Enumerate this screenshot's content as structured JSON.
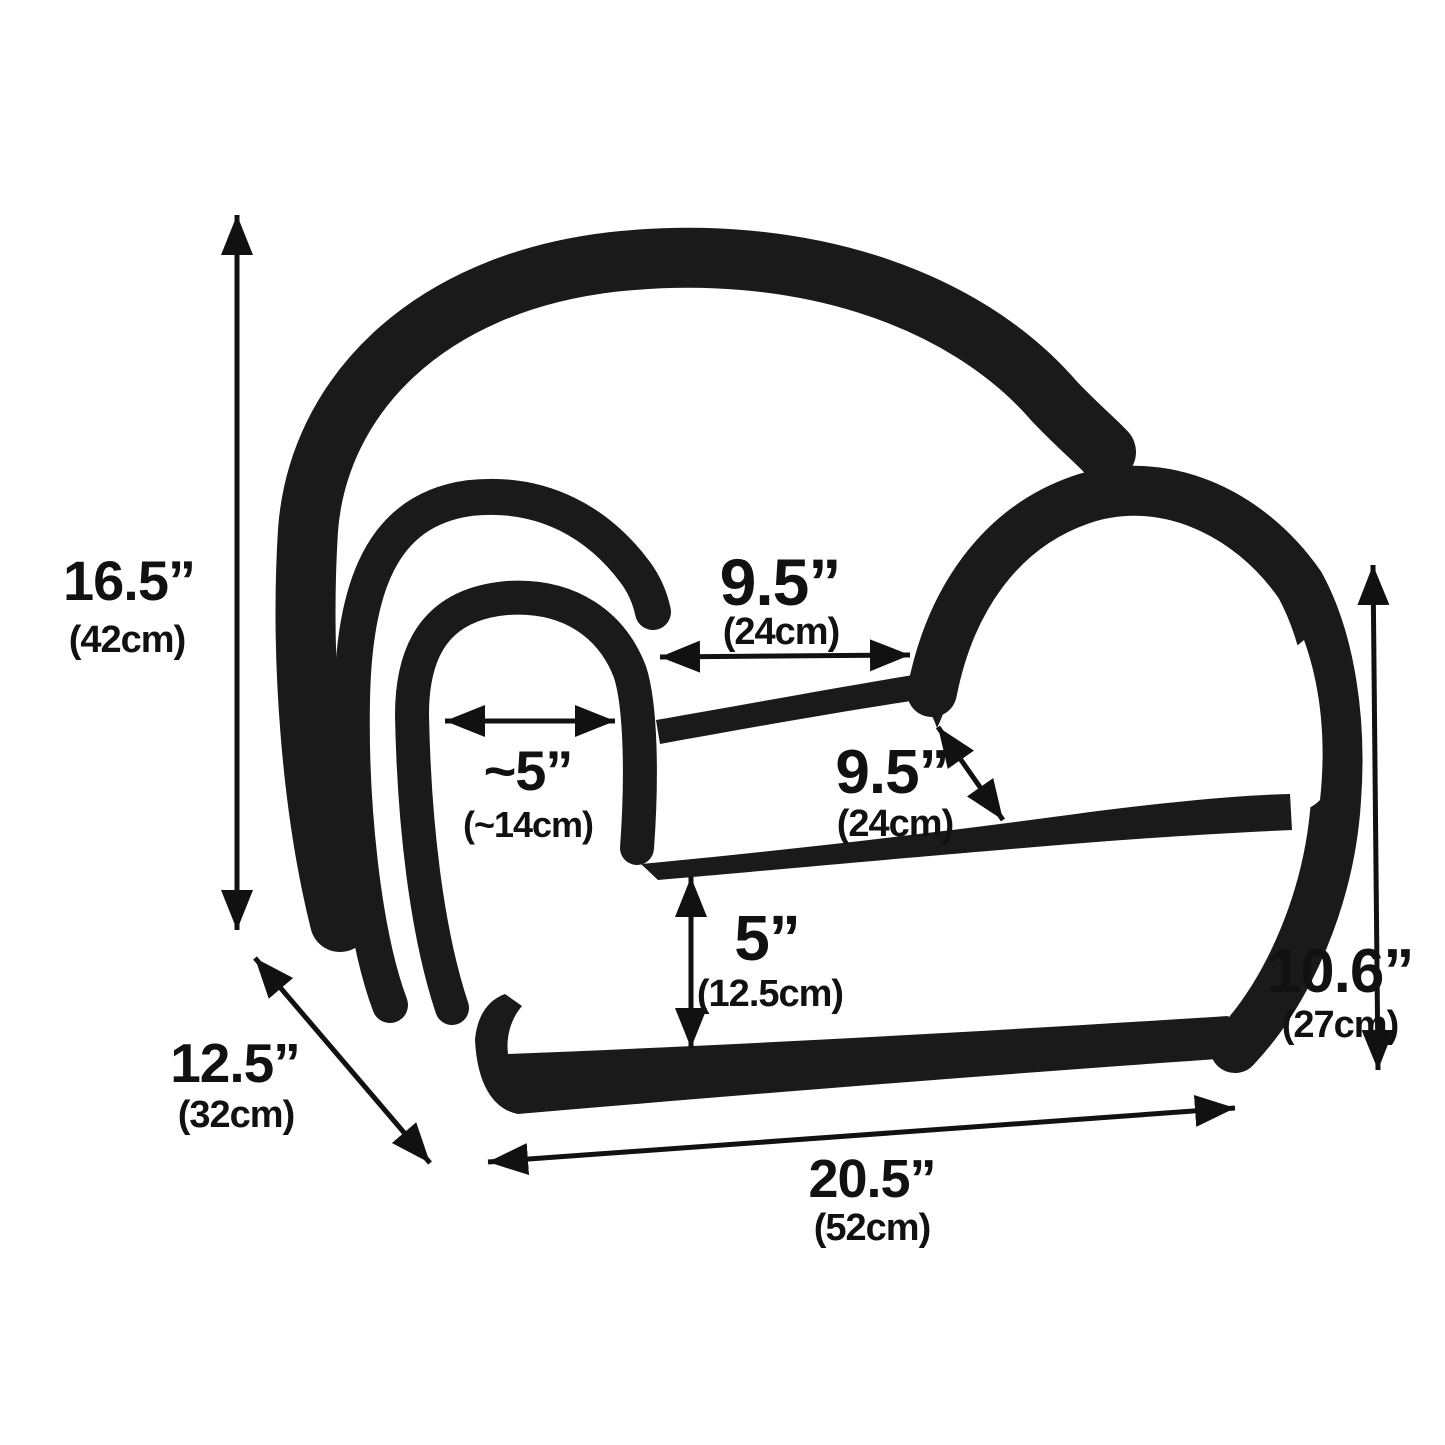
{
  "diagram": {
    "kind": "product-dimension-line-drawing",
    "subject": "kids foam armchair",
    "background_color": "#ffffff",
    "ink_color": "#1a1a1a",
    "dimensions": {
      "overall_height": {
        "inches": "16.5”",
        "metric": "(42cm)"
      },
      "depth": {
        "inches": "12.5”",
        "metric": "(32cm)"
      },
      "overall_width": {
        "inches": "20.5”",
        "metric": "(52cm)"
      },
      "back_height": {
        "inches": "10.6”",
        "metric": "(27cm)"
      },
      "seat_width": {
        "inches": "9.5”",
        "metric": "(24cm)"
      },
      "armrest_width": {
        "inches": "~5”",
        "metric": "(~14cm)"
      },
      "seat_depth": {
        "inches": "9.5”",
        "metric": "(24cm)"
      },
      "seat_height": {
        "inches": "5”",
        "metric": "(12.5cm)"
      }
    }
  }
}
